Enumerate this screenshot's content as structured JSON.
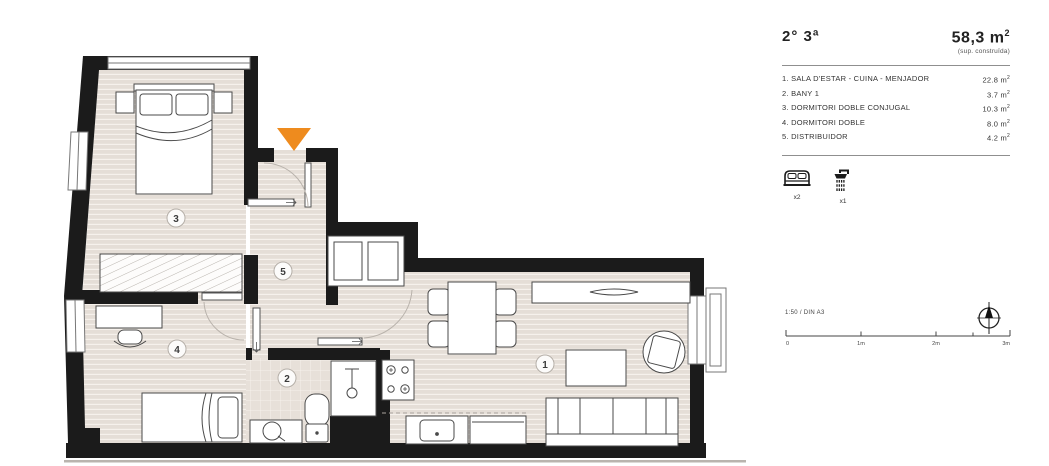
{
  "legend": {
    "unit_label": "2° 3ª",
    "total_area": "58,3",
    "area_unit": "m",
    "sup": "2",
    "area_note": "(sup. construïda)",
    "rooms": [
      {
        "name": "1. SALA D'ESTAR - CUINA - MENJADOR",
        "area": "22.8"
      },
      {
        "name": "2. BANY 1",
        "area": "3.7"
      },
      {
        "name": "3. DORMITORI DOBLE CONJUGAL",
        "area": "10.3"
      },
      {
        "name": "4. DORMITORI DOBLE",
        "area": "8.0"
      },
      {
        "name": "5. DISTRIBUIDOR",
        "area": "4.2"
      }
    ],
    "fixtures": {
      "bed_count": "x2",
      "shower_count": "x1"
    }
  },
  "plan": {
    "room_labels": {
      "living": "1",
      "bath": "2",
      "bedroom_main": "3",
      "bedroom_second": "4",
      "hall": "5"
    }
  },
  "scale": {
    "label": "1:50 / DIN A3",
    "ticks": [
      "0",
      "1m",
      "2m",
      "3m"
    ]
  },
  "colors": {
    "accent": "#ee8b1e",
    "wall": "#1b1b1b",
    "floor": "#e5ded7"
  }
}
